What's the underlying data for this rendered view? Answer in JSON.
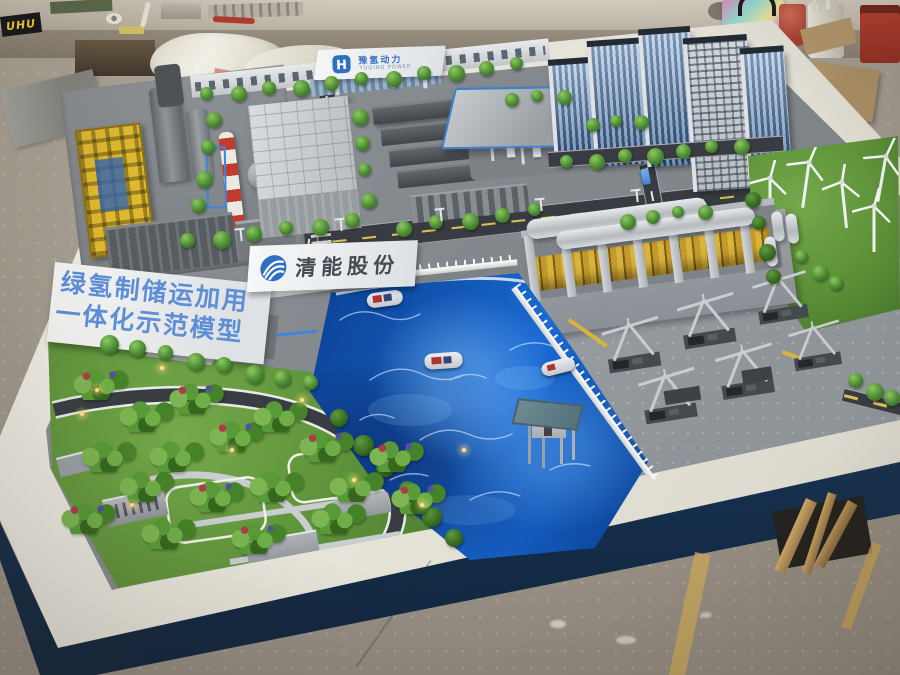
{
  "signs": {
    "banner": {
      "line1": "绿氢制储运加用",
      "line2": "一体化示范模型",
      "text_color": "#5d8ed6"
    },
    "company_sign": {
      "name": "清能股份",
      "text_color": "#454b52",
      "logo_color": "#2f6fc2"
    },
    "gate_sign": {
      "name": "豫氢动力",
      "name_en": "YUQING POWER",
      "logo_color": "#2f6fc2"
    },
    "glue_box": {
      "brand": "UHU",
      "brand_color": "#ffd82e"
    }
  },
  "colors": {
    "water_deep": "#0b3f92",
    "water_bright": "#1a6ad4",
    "grass": "#5f9338",
    "road": "#383c42",
    "table_frame": "#efece3",
    "base_skirt": "#16304e",
    "pipe_yellow": "#d9b33a",
    "chimney_red": "#c23b2c",
    "glass_blue": "#9fc4ea",
    "crane_yellow": "#dfb92e"
  }
}
